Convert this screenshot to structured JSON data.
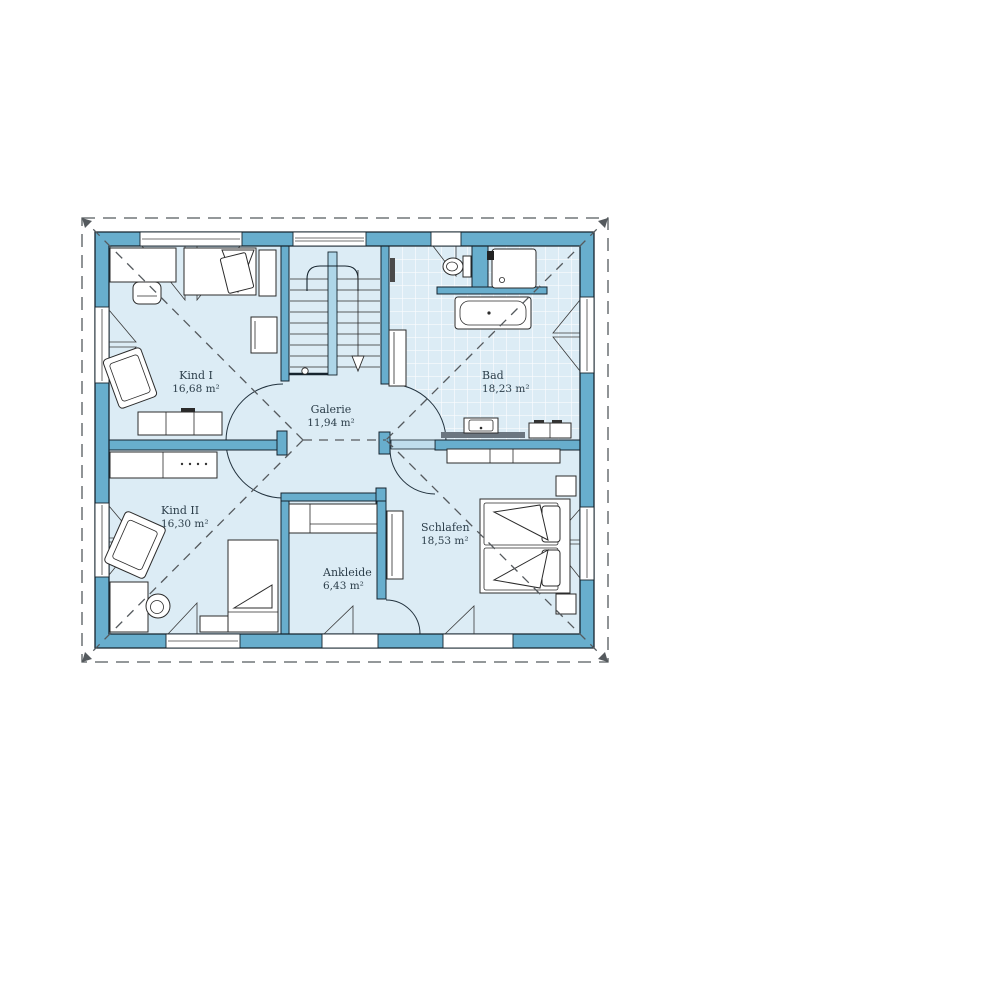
{
  "plan_title": "floor-plan",
  "rooms": {
    "kind1": {
      "label": "Kind I",
      "area": "16,68 m²"
    },
    "kind2": {
      "label": "Kind II",
      "area": "16,30 m²"
    },
    "galerie": {
      "label": "Galerie",
      "area": "11,94 m²"
    },
    "bad": {
      "label": "Bad",
      "area": "18,23 m²"
    },
    "schlafen": {
      "label": "Schlafen",
      "area": "18,53 m²"
    },
    "ankleide": {
      "label": "Ankleide",
      "area": "6,43 m²"
    }
  },
  "colors": {
    "wall": "#68aecd",
    "floor": "#dcecf5",
    "glass": "#c3e0ee",
    "outline": "#16242e",
    "tile_line": "#ffffff",
    "roof_dash_line": "#555a5e",
    "text": "#2c3e4a"
  }
}
